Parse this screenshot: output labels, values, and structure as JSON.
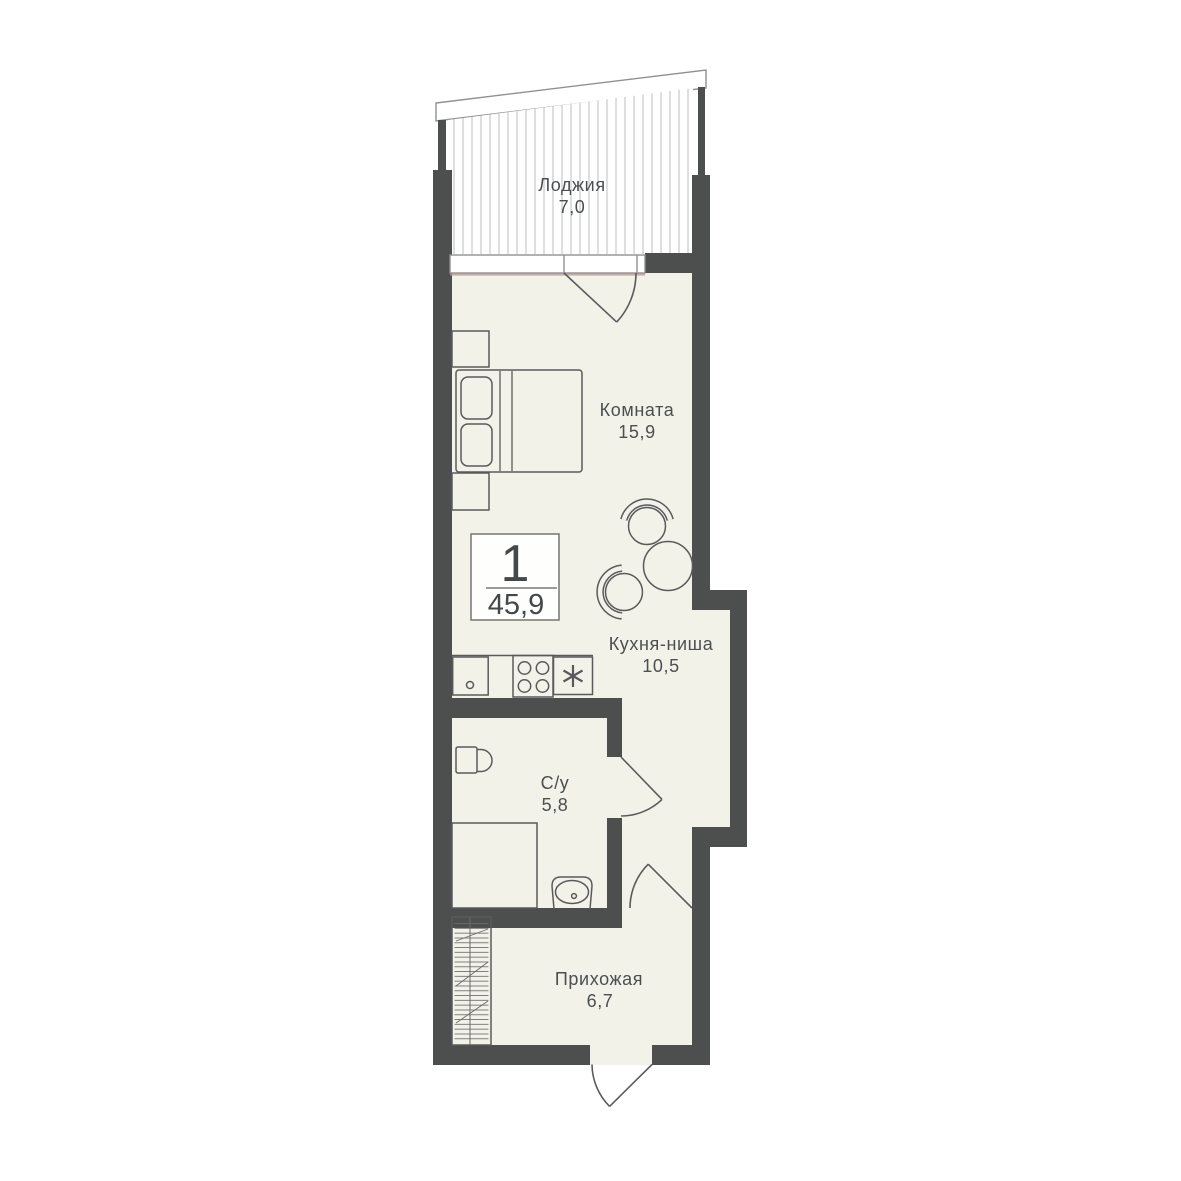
{
  "plan_badge": {
    "rooms_count": "1",
    "total_area": "45,9"
  },
  "rooms": [
    {
      "name": "Лоджия",
      "area": "7,0"
    },
    {
      "name": "Комната",
      "area": "15,9"
    },
    {
      "name": "Кухня-ниша",
      "area": "10,5"
    },
    {
      "name": "С/у",
      "area": "5,8"
    },
    {
      "name": "Прихожая",
      "area": "6,7"
    }
  ],
  "symbols": {
    "fridge_star": "✳"
  },
  "colors": {
    "wall": "#4d4f4e",
    "floor": "#f2f2e9",
    "furniture_outline": "#595a5c",
    "label_text": "#4a4f53",
    "loggia_stripe": "#c8c8c8",
    "window_sill": "#bc9288",
    "badge_border": "#7d7e79",
    "background": "#ffffff"
  }
}
